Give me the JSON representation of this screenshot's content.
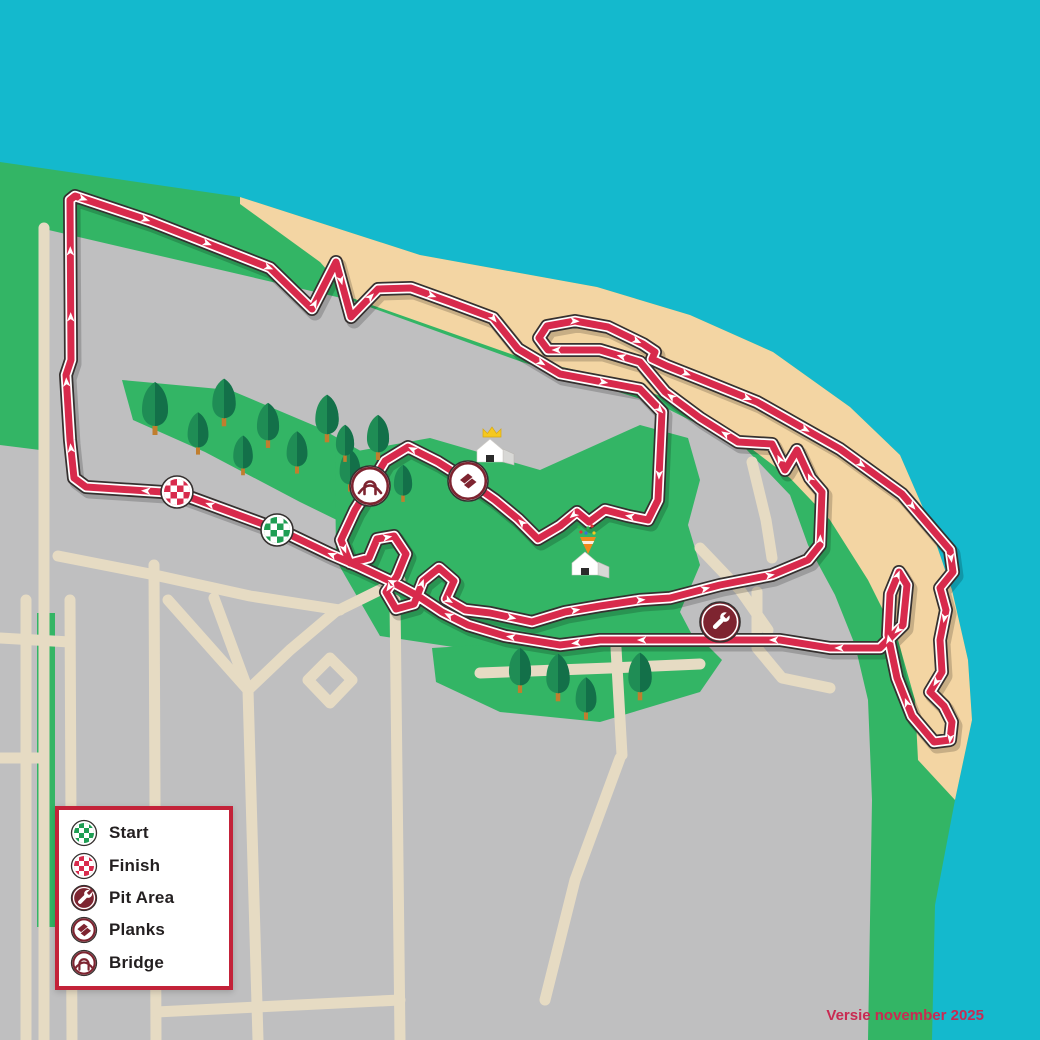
{
  "version_text": "Versie november 2025",
  "legend": {
    "items": [
      {
        "id": "start",
        "label": "Start",
        "icon": "start-checker-icon"
      },
      {
        "id": "finish",
        "label": "Finish",
        "icon": "finish-checker-icon"
      },
      {
        "id": "pit",
        "label": "Pit Area",
        "icon": "wrench-icon"
      },
      {
        "id": "planks",
        "label": "Planks",
        "icon": "planks-icon"
      },
      {
        "id": "bridge",
        "label": "Bridge",
        "icon": "bridge-icon"
      }
    ]
  },
  "colors": {
    "water": "#14B9CD",
    "land": "#33B565",
    "sand": "#F3D5A3",
    "city": "#BFBFC0",
    "road": "#E6DBC3",
    "track_red": "#D82A4C",
    "track_dark": "#35302F",
    "track_white": "#FFFFFF",
    "maroon": "#7E2430",
    "legend_border": "#C32239",
    "start_green": "#1E9E53",
    "finish_red": "#D82A4C",
    "tree_light": "#1F8D55",
    "tree_dark": "#137049",
    "trunk": "#C07E2E",
    "crown_yellow": "#F5C81F",
    "house_side": "#D8D8D6",
    "text": "#231F20",
    "version_text": "#C92A52"
  },
  "map": {
    "water_poly": [
      [
        0,
        0
      ],
      [
        1040,
        0
      ],
      [
        1040,
        1040
      ],
      [
        932,
        1040
      ],
      [
        935,
        905
      ],
      [
        955,
        800
      ],
      [
        972,
        720
      ],
      [
        968,
        660
      ],
      [
        952,
        590
      ],
      [
        927,
        517
      ],
      [
        900,
        455
      ],
      [
        850,
        407
      ],
      [
        773,
        352
      ],
      [
        690,
        315
      ],
      [
        597,
        287
      ],
      [
        420,
        255
      ],
      [
        240,
        197
      ],
      [
        0,
        162
      ]
    ],
    "sand_poly": [
      [
        240,
        197
      ],
      [
        420,
        255
      ],
      [
        597,
        287
      ],
      [
        690,
        315
      ],
      [
        773,
        352
      ],
      [
        850,
        407
      ],
      [
        900,
        455
      ],
      [
        927,
        517
      ],
      [
        952,
        590
      ],
      [
        968,
        660
      ],
      [
        972,
        720
      ],
      [
        955,
        800
      ],
      [
        918,
        760
      ],
      [
        915,
        700
      ],
      [
        898,
        640
      ],
      [
        868,
        580
      ],
      [
        830,
        520
      ],
      [
        790,
        478
      ],
      [
        740,
        440
      ],
      [
        690,
        408
      ],
      [
        620,
        380
      ],
      [
        522,
        358
      ],
      [
        352,
        298
      ],
      [
        320,
        262
      ],
      [
        240,
        204
      ]
    ],
    "sand_ellipse": {
      "cx": 595,
      "cy": 612,
      "rx": 85,
      "ry": 46,
      "rot": -8
    },
    "city_poly": [
      [
        40,
        228
      ],
      [
        350,
        300
      ],
      [
        522,
        362
      ],
      [
        660,
        405
      ],
      [
        745,
        448
      ],
      [
        790,
        495
      ],
      [
        808,
        545
      ],
      [
        835,
        595
      ],
      [
        855,
        645
      ],
      [
        868,
        700
      ],
      [
        872,
        800
      ],
      [
        868,
        1040
      ],
      [
        0,
        1040
      ],
      [
        0,
        445
      ],
      [
        40,
        450
      ]
    ],
    "park_poly": [
      [
        122,
        380
      ],
      [
        230,
        390
      ],
      [
        320,
        428
      ],
      [
        398,
        472
      ],
      [
        430,
        515
      ],
      [
        424,
        552
      ],
      [
        388,
        545
      ],
      [
        300,
        502
      ],
      [
        205,
        452
      ],
      [
        133,
        420
      ]
    ],
    "mid_green_poly": [
      [
        335,
        455
      ],
      [
        430,
        438
      ],
      [
        540,
        470
      ],
      [
        640,
        425
      ],
      [
        688,
        438
      ],
      [
        700,
        480
      ],
      [
        688,
        525
      ],
      [
        700,
        565
      ],
      [
        680,
        612
      ],
      [
        700,
        650
      ],
      [
        655,
        675
      ],
      [
        560,
        658
      ],
      [
        460,
        648
      ],
      [
        380,
        636
      ],
      [
        336,
        560
      ]
    ],
    "bottom_green_poly": [
      [
        432,
        648
      ],
      [
        560,
        640
      ],
      [
        700,
        638
      ],
      [
        722,
        660
      ],
      [
        700,
        692
      ],
      [
        600,
        722
      ],
      [
        500,
        712
      ],
      [
        436,
        682
      ]
    ],
    "left_green_strip": {
      "x": 37,
      "y": 613,
      "w": 18,
      "h": 314
    },
    "streets": [
      [
        [
          44,
          228
        ],
        [
          44,
          1040
        ]
      ],
      [
        [
          0,
          638
        ],
        [
          70,
          642
        ]
      ],
      [
        [
          26,
          600
        ],
        [
          26,
          1040
        ]
      ],
      [
        [
          70,
          600
        ],
        [
          72,
          1040
        ]
      ],
      [
        [
          154,
          565
        ],
        [
          156,
          1040
        ]
      ],
      [
        [
          248,
          690
        ],
        [
          168,
          600
        ]
      ],
      [
        [
          248,
          690
        ],
        [
          214,
          598
        ]
      ],
      [
        [
          248,
          690
        ],
        [
          258,
          1040
        ]
      ],
      [
        [
          248,
          690
        ],
        [
          290,
          650
        ],
        [
          335,
          612
        ],
        [
          400,
          580
        ]
      ],
      [
        [
          330,
          658
        ],
        [
          352,
          680
        ],
        [
          330,
          703
        ],
        [
          308,
          680
        ],
        [
          330,
          658
        ]
      ],
      [
        [
          156,
          1012
        ],
        [
          400,
          1000
        ]
      ],
      [
        [
          58,
          556
        ],
        [
          150,
          574
        ],
        [
          250,
          596
        ],
        [
          340,
          610
        ]
      ],
      [
        [
          480,
          673
        ],
        [
          610,
          668
        ],
        [
          700,
          664
        ]
      ],
      [
        [
          616,
          648
        ],
        [
          622,
          755
        ]
      ],
      [
        [
          700,
          548
        ],
        [
          740,
          590
        ],
        [
          768,
          630
        ]
      ],
      [
        [
          752,
          462
        ],
        [
          766,
          520
        ],
        [
          772,
          558
        ]
      ],
      [
        [
          757,
          592
        ],
        [
          757,
          648
        ],
        [
          782,
          678
        ],
        [
          830,
          688
        ]
      ],
      [
        [
          0,
          758
        ],
        [
          44,
          758
        ]
      ],
      [
        [
          395,
          600
        ],
        [
          400,
          1040
        ]
      ],
      [
        [
          620,
          758
        ],
        [
          575,
          880
        ],
        [
          545,
          1000
        ]
      ]
    ],
    "track_path": [
      [
        74,
        478
      ],
      [
        70,
        440
      ],
      [
        66,
        375
      ],
      [
        71,
        360
      ],
      [
        70,
        200
      ],
      [
        75,
        196
      ],
      [
        150,
        221
      ],
      [
        270,
        268
      ],
      [
        312,
        309
      ],
      [
        336,
        262
      ],
      [
        351,
        317
      ],
      [
        378,
        289
      ],
      [
        411,
        288
      ],
      [
        450,
        302
      ],
      [
        493,
        318
      ],
      [
        518,
        349
      ],
      [
        560,
        374
      ],
      [
        640,
        389
      ],
      [
        662,
        412
      ],
      [
        658,
        500
      ],
      [
        648,
        520
      ],
      [
        628,
        516
      ],
      [
        605,
        510
      ],
      [
        589,
        522
      ],
      [
        577,
        512
      ],
      [
        560,
        526
      ],
      [
        538,
        539
      ],
      [
        518,
        519
      ],
      [
        495,
        500
      ],
      [
        468,
        481
      ],
      [
        438,
        462
      ],
      [
        408,
        447
      ],
      [
        385,
        461
      ],
      [
        370,
        486
      ],
      [
        355,
        510
      ],
      [
        341,
        540
      ],
      [
        350,
        563
      ],
      [
        369,
        558
      ],
      [
        377,
        539
      ],
      [
        394,
        536
      ],
      [
        406,
        554
      ],
      [
        397,
        576
      ],
      [
        386,
        592
      ],
      [
        396,
        609
      ],
      [
        414,
        604
      ],
      [
        423,
        581
      ],
      [
        439,
        568
      ],
      [
        454,
        581
      ],
      [
        446,
        599
      ],
      [
        465,
        610
      ],
      [
        490,
        613
      ],
      [
        532,
        622
      ],
      [
        565,
        612
      ],
      [
        600,
        606
      ],
      [
        640,
        600
      ],
      [
        670,
        598
      ],
      [
        720,
        585
      ],
      [
        772,
        575
      ],
      [
        808,
        560
      ],
      [
        820,
        545
      ],
      [
        822,
        492
      ],
      [
        810,
        478
      ],
      [
        797,
        450
      ],
      [
        785,
        470
      ],
      [
        772,
        444
      ],
      [
        738,
        442
      ],
      [
        700,
        418
      ],
      [
        665,
        392
      ],
      [
        640,
        362
      ],
      [
        600,
        350
      ],
      [
        565,
        350
      ],
      [
        548,
        350
      ],
      [
        539,
        338
      ],
      [
        547,
        326
      ],
      [
        575,
        321
      ],
      [
        608,
        327
      ],
      [
        643,
        344
      ],
      [
        655,
        352
      ],
      [
        652,
        359
      ],
      [
        667,
        366
      ],
      [
        700,
        379
      ],
      [
        757,
        402
      ],
      [
        840,
        449
      ],
      [
        902,
        494
      ],
      [
        938,
        536
      ],
      [
        950,
        550
      ],
      [
        953,
        572
      ],
      [
        940,
        588
      ],
      [
        946,
        610
      ],
      [
        940,
        640
      ],
      [
        942,
        672
      ],
      [
        930,
        692
      ],
      [
        944,
        706
      ],
      [
        952,
        722
      ],
      [
        950,
        740
      ],
      [
        934,
        742
      ],
      [
        912,
        716
      ],
      [
        897,
        678
      ],
      [
        888,
        635
      ],
      [
        890,
        594
      ],
      [
        899,
        572
      ],
      [
        907,
        585
      ],
      [
        903,
        625
      ],
      [
        880,
        648
      ],
      [
        830,
        648
      ],
      [
        780,
        640
      ],
      [
        700,
        640
      ],
      [
        650,
        640
      ],
      [
        600,
        640
      ],
      [
        560,
        645
      ],
      [
        505,
        636
      ],
      [
        468,
        625
      ],
      [
        442,
        612
      ],
      [
        418,
        596
      ],
      [
        392,
        582
      ],
      [
        358,
        566
      ],
      [
        330,
        554
      ],
      [
        282,
        531
      ],
      [
        192,
        498
      ],
      [
        178,
        493
      ],
      [
        86,
        487
      ],
      [
        74,
        478
      ]
    ],
    "arrow_spacing": 66,
    "markers": [
      {
        "type": "checker",
        "id": "finish-marker",
        "x": 177,
        "y": 492,
        "r": 16,
        "color": "#D82A4C"
      },
      {
        "type": "checker",
        "id": "start-marker",
        "x": 277,
        "y": 530,
        "r": 16,
        "color": "#1E9E53"
      },
      {
        "type": "bridge",
        "id": "bridge-marker",
        "x": 370,
        "y": 486,
        "r": 20
      },
      {
        "type": "planks",
        "id": "planks-marker",
        "x": 468,
        "y": 481,
        "r": 20
      },
      {
        "type": "pit",
        "id": "pit-marker",
        "x": 720,
        "y": 622,
        "r": 20
      }
    ],
    "trees": [
      {
        "x": 155,
        "y": 408,
        "s": 1.0
      },
      {
        "x": 198,
        "y": 433,
        "s": 0.8
      },
      {
        "x": 224,
        "y": 402,
        "s": 0.9
      },
      {
        "x": 243,
        "y": 455,
        "s": 0.75
      },
      {
        "x": 268,
        "y": 425,
        "s": 0.85
      },
      {
        "x": 297,
        "y": 452,
        "s": 0.8
      },
      {
        "x": 327,
        "y": 418,
        "s": 0.9
      },
      {
        "x": 350,
        "y": 470,
        "s": 0.8
      },
      {
        "x": 378,
        "y": 437,
        "s": 0.85
      },
      {
        "x": 345,
        "y": 443,
        "s": 0.7
      },
      {
        "x": 403,
        "y": 483,
        "s": 0.7
      },
      {
        "x": 520,
        "y": 670,
        "s": 0.85
      },
      {
        "x": 558,
        "y": 677,
        "s": 0.9
      },
      {
        "x": 586,
        "y": 698,
        "s": 0.8
      },
      {
        "x": 640,
        "y": 676,
        "s": 0.9
      }
    ],
    "houses": [
      {
        "x": 490,
        "y": 452,
        "deco": "crown"
      },
      {
        "x": 585,
        "y": 565,
        "deco": "cone"
      }
    ]
  }
}
